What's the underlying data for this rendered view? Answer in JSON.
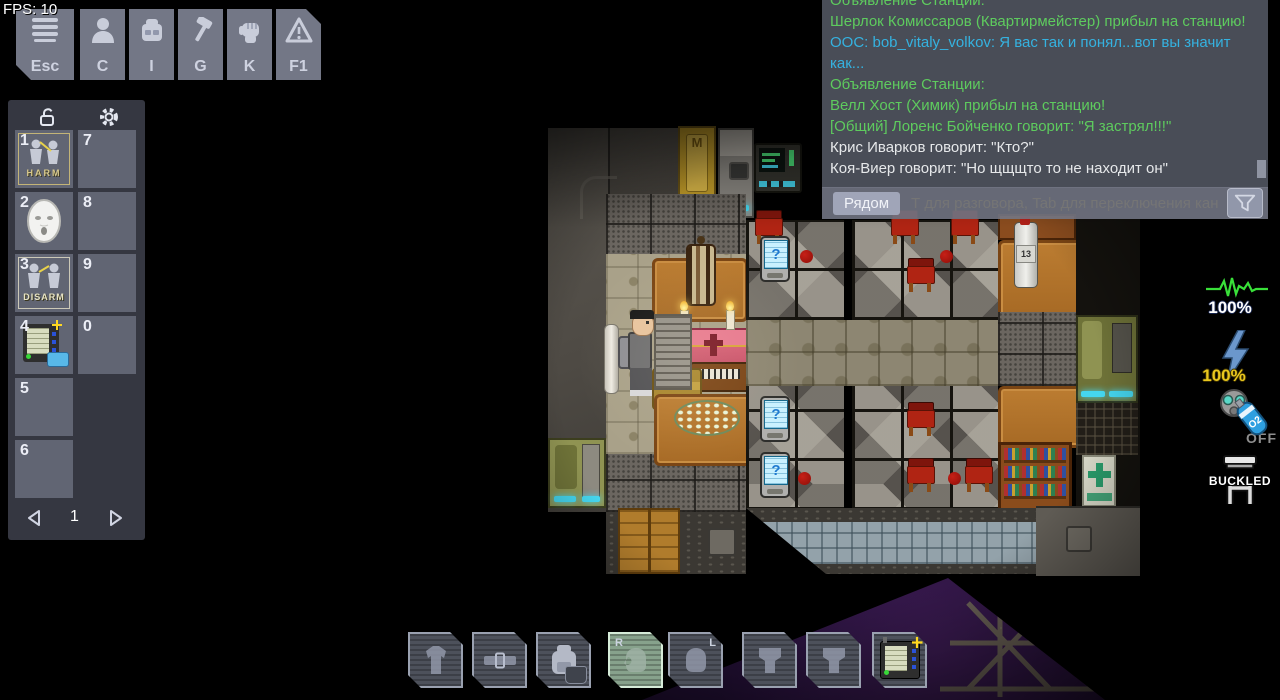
{
  "hud": {
    "fps_label": "FPS: 10",
    "menu_buttons": [
      {
        "label": "Esc",
        "icon": "menu-icon"
      },
      {
        "label": "C",
        "icon": "person-icon"
      },
      {
        "label": "I",
        "icon": "backpack-icon"
      },
      {
        "label": "G",
        "icon": "hammer-icon"
      },
      {
        "label": "K",
        "icon": "fist-icon"
      },
      {
        "label": "F1",
        "icon": "warning-icon"
      }
    ]
  },
  "hotbar": {
    "slots": [
      {
        "number": "1",
        "item": "harm-intent",
        "label": "HARM"
      },
      {
        "number": "2",
        "item": "mask",
        "label": ""
      },
      {
        "number": "3",
        "item": "disarm-intent",
        "label": "DISARM"
      },
      {
        "number": "4",
        "item": "pda",
        "label": ""
      },
      {
        "number": "5",
        "item": "",
        "label": ""
      },
      {
        "number": "6",
        "item": "",
        "label": ""
      },
      {
        "number": "7",
        "item": "",
        "label": ""
      },
      {
        "number": "8",
        "item": "",
        "label": ""
      },
      {
        "number": "9",
        "item": "",
        "label": ""
      },
      {
        "number": "0",
        "item": "",
        "label": ""
      }
    ],
    "page": "1"
  },
  "chat": {
    "messages": [
      {
        "color": "green",
        "text": "Объявление Станции:"
      },
      {
        "color": "green",
        "text": "Шерлок Комиссаров (Квартирмейстер) прибыл на станцию!"
      },
      {
        "color": "cyan",
        "text": "OOC: bob_vitaly_volkov: Я вас так и понял...вот вы значит как..."
      },
      {
        "color": "green",
        "text": "Объявление Станции:"
      },
      {
        "color": "green",
        "text": "Велл Хост (Химик) прибыл на станцию!"
      },
      {
        "color": "green",
        "text": "[Общий] Лоренс Бойченко говорит: \"Я застрял!!!\""
      },
      {
        "color": "white",
        "text": "Крис Иварков говорит: \"Кто?\""
      },
      {
        "color": "white",
        "text": "Коя-Виер говорит: \"Но щщщто то не находит он\""
      }
    ],
    "channel_button": "Рядом",
    "input_placeholder": "Т для разговора, Tab для переключения кана"
  },
  "status": {
    "health": "100%",
    "power": "100%",
    "internals": "OFF",
    "buckled": "BUCKLED"
  },
  "inventory": {
    "slots": [
      {
        "name": "exosuit",
        "label": ""
      },
      {
        "name": "belt",
        "label": ""
      },
      {
        "name": "backpack",
        "label": ""
      },
      {
        "name": "right-hand",
        "label": "R"
      },
      {
        "name": "left-hand",
        "label": "L"
      },
      {
        "name": "pocket-left",
        "label": ""
      },
      {
        "name": "pocket-right",
        "label": ""
      },
      {
        "name": "pda",
        "label": ""
      }
    ]
  },
  "game": {
    "tablet_glyph": "?",
    "bottle_label": "13",
    "gold_door_emblem": "M"
  },
  "colors": {
    "chat_green": "#5ecb5e",
    "chat_cyan": "#35b2e0",
    "chat_white": "#e6e8ea",
    "health_green": "#39e039",
    "power_yellow": "#e9c71e",
    "internals_gray": "#8e8e8e",
    "active_hand_green": "#87a28c",
    "airlock_light_cyan": "#45d6ef",
    "space_purple": "#2c1240"
  }
}
